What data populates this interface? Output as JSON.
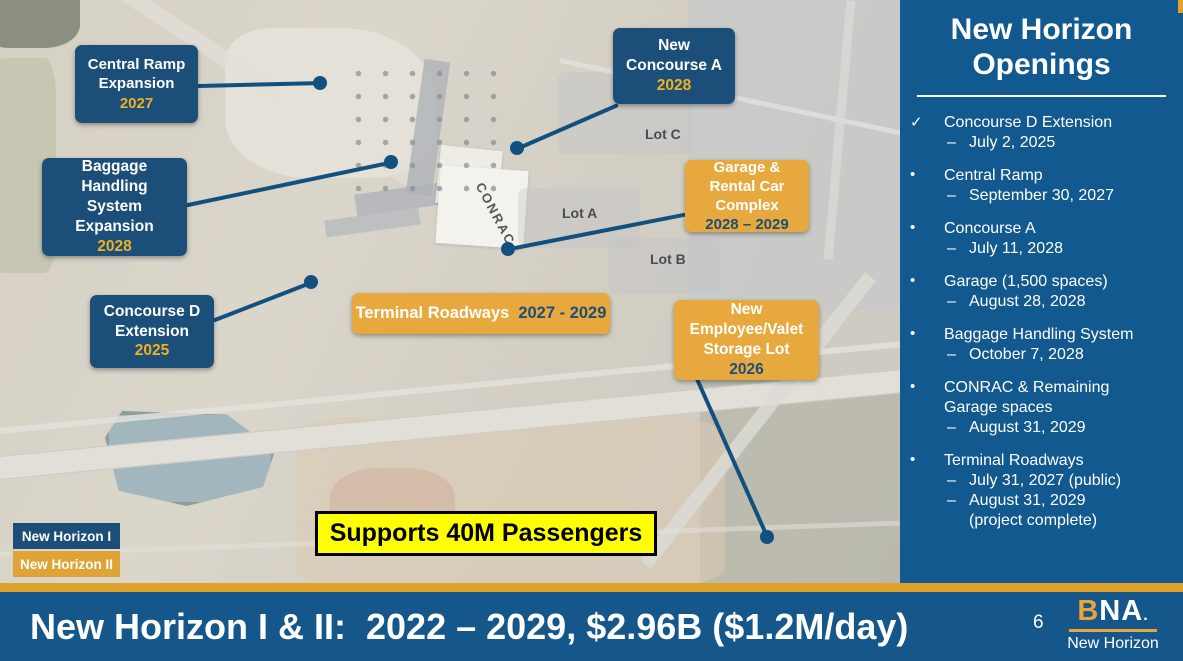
{
  "map": {
    "callouts": [
      {
        "id": "central-ramp",
        "title": "Central Ramp Expansion",
        "year": "2027",
        "phase": "New Horizon I"
      },
      {
        "id": "new-concourse-a",
        "title": "New Concourse A",
        "year": "2028",
        "phase": "New Horizon I"
      },
      {
        "id": "baggage",
        "title": "Baggage Handling System Expansion",
        "year": "2028",
        "phase": "New Horizon I"
      },
      {
        "id": "concourse-d",
        "title": "Concourse D Extension",
        "year": "2025",
        "phase": "New Horizon I"
      },
      {
        "id": "garage-conrac",
        "title": "Garage & Rental Car Complex",
        "year": "2028 – 2029",
        "phase": "New Horizon II"
      },
      {
        "id": "terminal-roadways",
        "title": "Terminal Roadways",
        "year": "2027 - 2029",
        "phase": "New Horizon II"
      },
      {
        "id": "employee-valet",
        "title": "New Employee/Valet Storage Lot",
        "year": "2026",
        "phase": "New Horizon II"
      }
    ],
    "area_labels": {
      "conrac": "CONRAC",
      "lot_c": "Lot C",
      "lot_a": "Lot A",
      "lot_b": "Lot B"
    },
    "banner": "Supports 40M Passengers",
    "legend": [
      {
        "label": "New Horizon I",
        "color": "#1b4e79"
      },
      {
        "label": "New Horizon II",
        "color": "#dfa336"
      }
    ]
  },
  "sidebar": {
    "title_line1": "New Horizon",
    "title_line2": "Openings",
    "date_marker": "–",
    "items": [
      {
        "marker": "✓",
        "title": "Concourse D Extension",
        "dates": [
          "July 2, 2025"
        ]
      },
      {
        "marker": "•",
        "title": "Central Ramp",
        "dates": [
          "September 30, 2027"
        ]
      },
      {
        "marker": "•",
        "title": "Concourse A",
        "dates": [
          "July 11, 2028"
        ]
      },
      {
        "marker": "•",
        "title": "Garage (1,500 spaces)",
        "dates": [
          "August 28, 2028"
        ]
      },
      {
        "marker": "•",
        "title": "Baggage Handling System",
        "dates": [
          "October 7, 2028"
        ]
      },
      {
        "marker": "•",
        "title": "CONRAC & Remaining Garage spaces",
        "dates": [
          "August 31, 2029"
        ]
      },
      {
        "marker": "•",
        "title": "Terminal Roadways",
        "dates": [
          "July 31, 2027  (public)",
          "August 31, 2029 (project complete)"
        ]
      }
    ]
  },
  "footer": {
    "headline": "New Horizon I & II:  2022 – 2029, $2.96B ($1.2M/day)",
    "page_number": "6",
    "logo": {
      "b": "B",
      "na": "NA",
      "dot": ".",
      "tagline": "New Horizon"
    }
  },
  "colors": {
    "navy_box": "#1b4e79",
    "gold_box": "#e7a93e",
    "sidebar_blue": "#11598e",
    "footer_blue": "#15578a",
    "gold_strip": "#dfa32c",
    "year_gold": "#f0b11d",
    "banner_yellow": "#ffff00",
    "leader_line": "#11507f"
  }
}
